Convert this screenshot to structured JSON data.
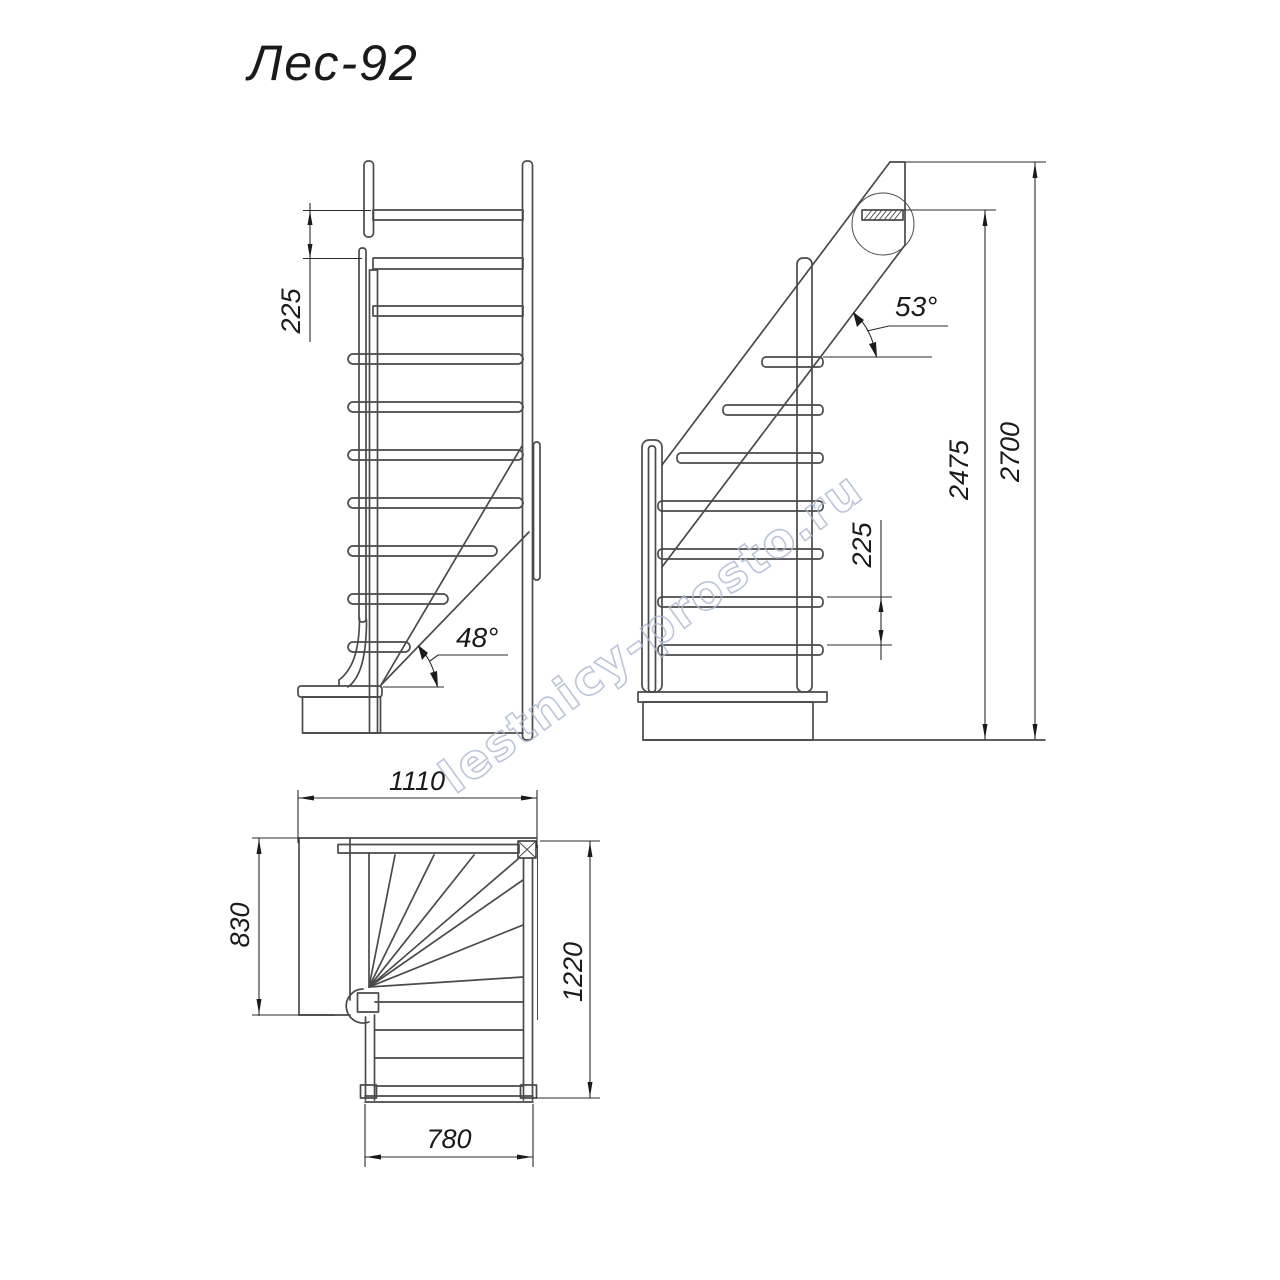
{
  "title": "Лес-92",
  "watermark": "lestnicy-prosto.ru",
  "views": {
    "front": {
      "name": "front elevation of winder staircase",
      "riser_dim": "225",
      "slope_angle": "48°"
    },
    "side": {
      "name": "side elevation of winder staircase",
      "slope_angle": "53°",
      "riser_dim": "225",
      "height_to_top_tread": "2475",
      "height_total": "2700"
    },
    "plan": {
      "name": "plan view of winder staircase",
      "width_top": "1110",
      "depth_left": "830",
      "depth_right": "1220",
      "width_bottom": "780"
    }
  },
  "colors": {
    "line": "#4a4a4a",
    "dimension": "#2b2b2b",
    "text": "#1a1a1a",
    "watermark": "#a9b7cf",
    "background": "#ffffff"
  }
}
